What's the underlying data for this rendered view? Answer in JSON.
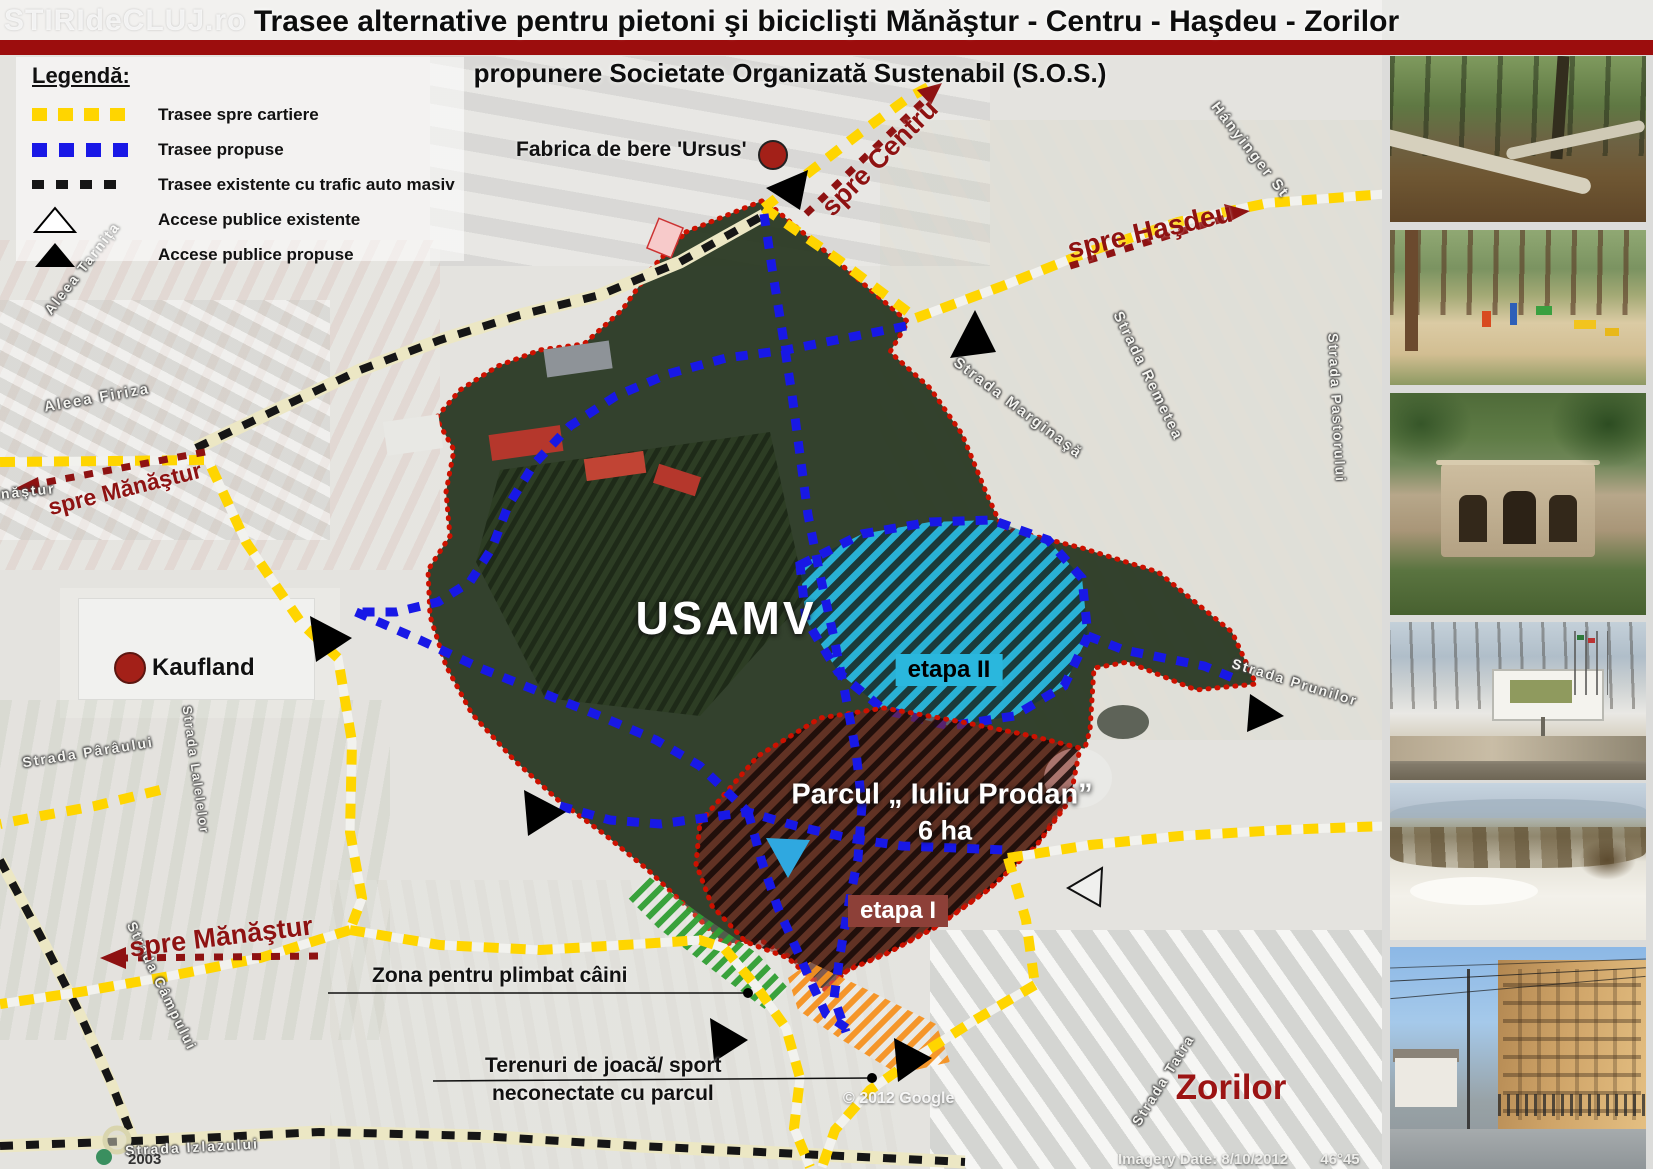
{
  "header": {
    "title": "Trasee alternative pentru pietoni şi biciclişti Mănăştur - Centru - Haşdeu - Zorilor",
    "subtitle": "propunere Societate Organizată Sustenabil (S.O.S.)",
    "watermark": "STIRIdeCLUJ.ro"
  },
  "legend": {
    "heading": "Legendă:",
    "items": [
      {
        "id": "yellow-dashes",
        "label": "Trasee spre cartiere",
        "color": "#ffd500"
      },
      {
        "id": "blue-dashes",
        "label": "Trasee propuse",
        "color": "#1818e6"
      },
      {
        "id": "black-dashes",
        "label": "Trasee existente cu trafic auto masiv",
        "color": "#161616"
      },
      {
        "id": "white-triangle",
        "label": "Accese publice existente",
        "color": "#ffffff"
      },
      {
        "id": "black-triangle",
        "label": "Accese publice propuse",
        "color": "#000000"
      }
    ]
  },
  "map": {
    "pois": {
      "ursus": "Fabrica de bere 'Ursus'",
      "kaufland": "Kaufland",
      "usamv": "USAMV",
      "zorilor": "Zorilor"
    },
    "zones": {
      "etapa2": "etapa II",
      "etapa1": "etapa I",
      "park_name": "Parcul „ Iuliu Prodan”",
      "park_area": "6 ha",
      "dog_zone": "Zona pentru plimbat câini",
      "play_line1": "Terenuri de joacă/ sport",
      "play_line2": "neconectate cu parcul"
    },
    "directions": {
      "centru": "spre Centru",
      "hasdeu": "spre Haşdeu",
      "manastur_nv": "spre Mănăştur",
      "manastur_sv": "spre Mănăştur"
    },
    "streets": [
      "Hányinger St",
      "Strada Remetea",
      "Strada Marginaşă",
      "Strada Pastorului",
      "Strada Prunilor",
      "Strada Tatra",
      "Aleea Tarnița",
      "Aleea Firiza",
      "Strada Pârâului",
      "Strada Lalelelor",
      "Strada Câmpului",
      "Strada Izlazului",
      "Calea Mănăştur"
    ],
    "credits": {
      "google": "© 2012 Google",
      "imagery": "Imagery Date: 8/10/2012",
      "coords": "46°45",
      "year": "2003"
    },
    "colors": {
      "title_bar": "#9c0d0d",
      "route_cartiere": "#ffd500",
      "route_propuse": "#1818e6",
      "route_existente": "#161616",
      "direction_red": "#8e1212",
      "etapa2_fill": "#2ab7dd",
      "etapa1_fill": "#7b2822",
      "dog_zone_green": "#2f9e33",
      "play_zone_orange": "#f59120",
      "boundary_red": "#cc1100"
    }
  },
  "photos": [
    {
      "id": "park-path-new"
    },
    {
      "id": "forest-playground"
    },
    {
      "id": "ruined-chapel"
    },
    {
      "id": "winter-park-sign"
    },
    {
      "id": "snowy-meadow"
    },
    {
      "id": "street-buildings"
    }
  ]
}
